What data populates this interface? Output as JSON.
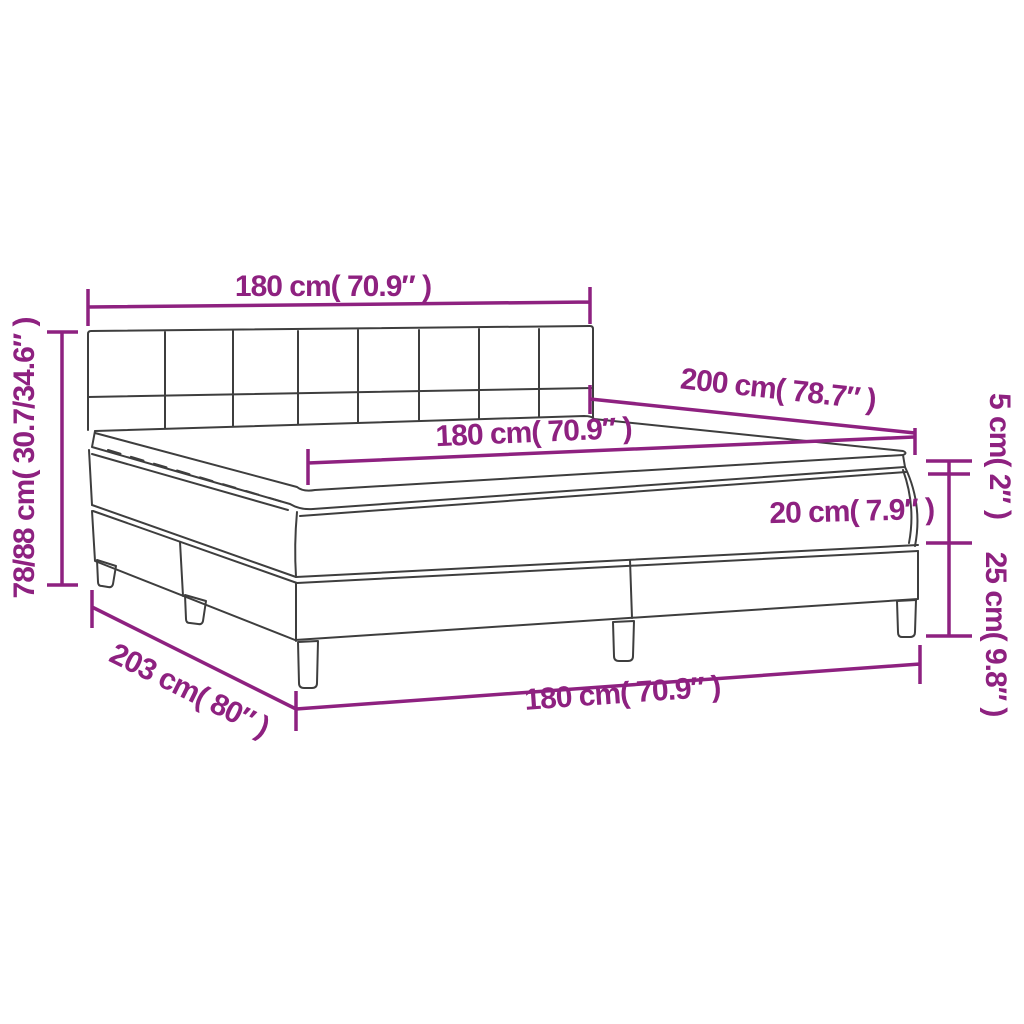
{
  "colors": {
    "dimension": "#8e2180",
    "outline": "#3e3e3e",
    "background": "#ffffff"
  },
  "dimensions": {
    "headboard_width": {
      "label": "180 cm( 70.9″ )"
    },
    "bed_height": {
      "label": "78/88 cm( 30.7/34.6″ )"
    },
    "bed_length": {
      "label": "200 cm( 78.7″ )"
    },
    "mattress_width": {
      "label": "180 cm( 70.9″ )"
    },
    "mattress_height": {
      "label": "20 cm( 7.9″ )"
    },
    "topper_height": {
      "label": "5 cm( 2″ )"
    },
    "base_height": {
      "label": "25 cm( 9.8″ )"
    },
    "total_length": {
      "label": "203 cm( 80″ )"
    },
    "base_width": {
      "label": "180 cm( 70.9″ )"
    }
  }
}
